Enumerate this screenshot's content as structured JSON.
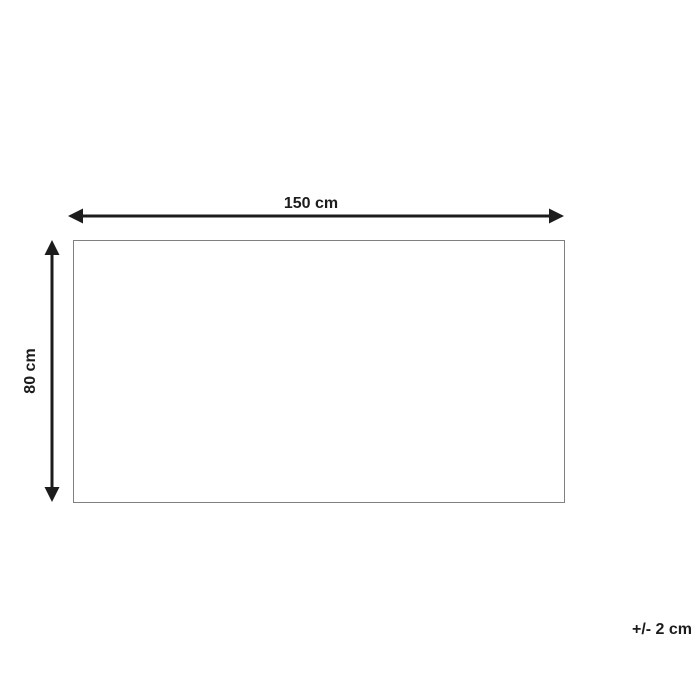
{
  "diagram": {
    "title": "product-dimension-diagram",
    "width_label": "150 cm",
    "height_label": "80 cm",
    "tolerance_label": "+/- 2 cm",
    "shape": "rectangle",
    "width_value_cm": 150,
    "height_value_cm": 80,
    "tolerance_value_cm": 2
  },
  "colors": {
    "arrow": "#1c1c1c",
    "text": "#1c1c1c",
    "outline": "#808080",
    "background": "#ffffff"
  }
}
